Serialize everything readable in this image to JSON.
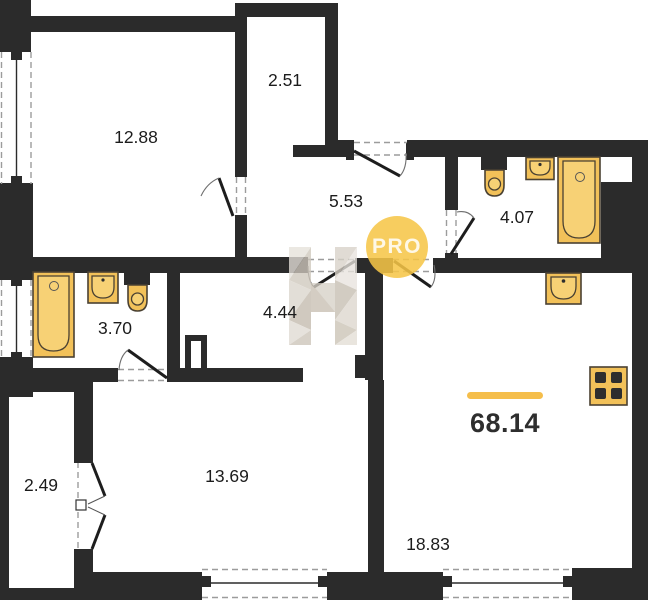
{
  "plan": {
    "watermark": {
      "badge": "PRO"
    },
    "total": {
      "area": "68.14"
    },
    "rooms": [
      {
        "name": "room-top-left",
        "area": "12.88"
      },
      {
        "name": "wardrobe",
        "area": "2.51"
      },
      {
        "name": "hallway",
        "area": "5.53"
      },
      {
        "name": "bathroom-right",
        "area": "4.07"
      },
      {
        "name": "bathroom-left",
        "area": "3.70"
      },
      {
        "name": "inner-hall",
        "area": "4.44"
      },
      {
        "name": "bedroom",
        "area": "13.69"
      },
      {
        "name": "balcony",
        "area": "2.49"
      },
      {
        "name": "kitchen-living",
        "area": "18.83"
      }
    ],
    "colors": {
      "wall": "#2b2b2b",
      "fixture": "#f2c159",
      "fixtureInner": "#f7d175",
      "accent": "#f5be4b",
      "badge": "#f6c647"
    }
  }
}
